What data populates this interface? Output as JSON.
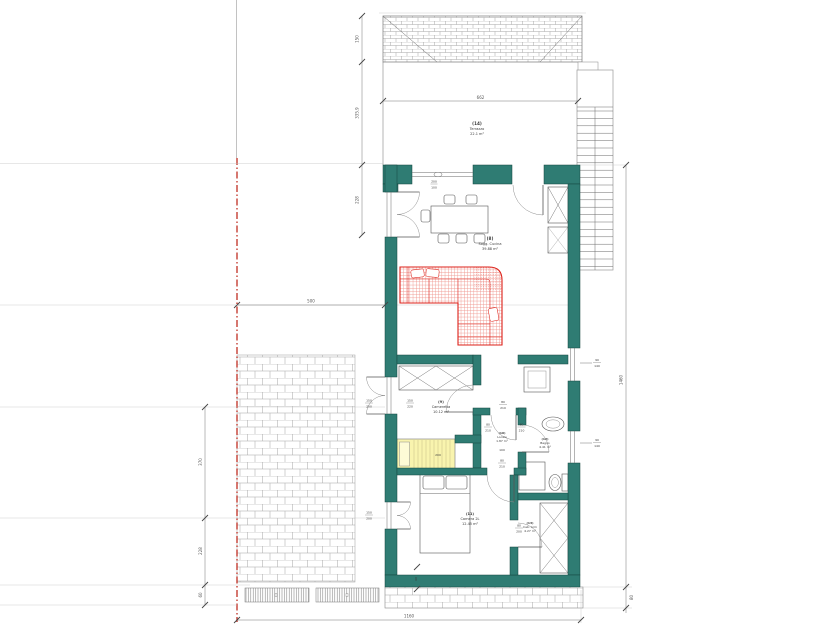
{
  "drawing": {
    "type_label": "residential floor plan"
  },
  "rooms": {
    "terrazzo": {
      "code": "(14)",
      "name": "Terrazzo",
      "area": "22.1 m²"
    },
    "soggiorno": {
      "code": "(8)",
      "name": "Sogg. Cucina",
      "area": "39.88 m²"
    },
    "cameretta": {
      "code": "(9)",
      "name": "Cameretta",
      "area": "10.12 m²"
    },
    "locale": {
      "code": "(10)",
      "name": "Locale",
      "area": "1.87 m²"
    },
    "bagno": {
      "code": "(12)",
      "name": "Bagno",
      "area": "4.41 m²"
    },
    "camera": {
      "code": "(11)",
      "name": "Camera 2L",
      "area": "12.45 m²"
    },
    "cabarmadio": {
      "code": "(13)",
      "name": "Cab. Arm",
      "area": "4.27 m²"
    }
  },
  "dimensions": {
    "terrace_width": "662",
    "roof_depth": "150",
    "terrace_depth": "335.9",
    "wall_segment": "228",
    "side_setback": "500",
    "garden_a": "370",
    "garden_b": "228",
    "garden_c": "60",
    "total_width": "1160",
    "total_height": "1460",
    "walkway_depth": "80",
    "wall_note": "60",
    "bed_length": "200",
    "level_note": "100"
  },
  "openings": {
    "kitchen_window": {
      "w": "200",
      "h": "100"
    },
    "terrace_door_out": {
      "w": "150",
      "h": "200"
    },
    "terrace_door_in": {
      "w": "150",
      "h": "220"
    },
    "camera_door_out": {
      "w": "150",
      "h": "200"
    },
    "window_right_a": {
      "w": "90",
      "h": "140"
    },
    "window_right_b": {
      "w": "90",
      "h": "140"
    },
    "hall_door": {
      "w": "80",
      "h": "210"
    },
    "cameretta_door": {
      "w": "80",
      "h": "210"
    },
    "bagno_door": {
      "w": "80",
      "h": "210"
    },
    "camera_door": {
      "w": "80",
      "h": "210"
    },
    "cabina_door": {
      "w": "80",
      "h": "200"
    }
  },
  "colors": {
    "wall_teal": "#2f7c73",
    "sofa_red": "#dd2018",
    "bed_yellow": "#f9f4ae",
    "property_line_red": "#bf2e22"
  }
}
